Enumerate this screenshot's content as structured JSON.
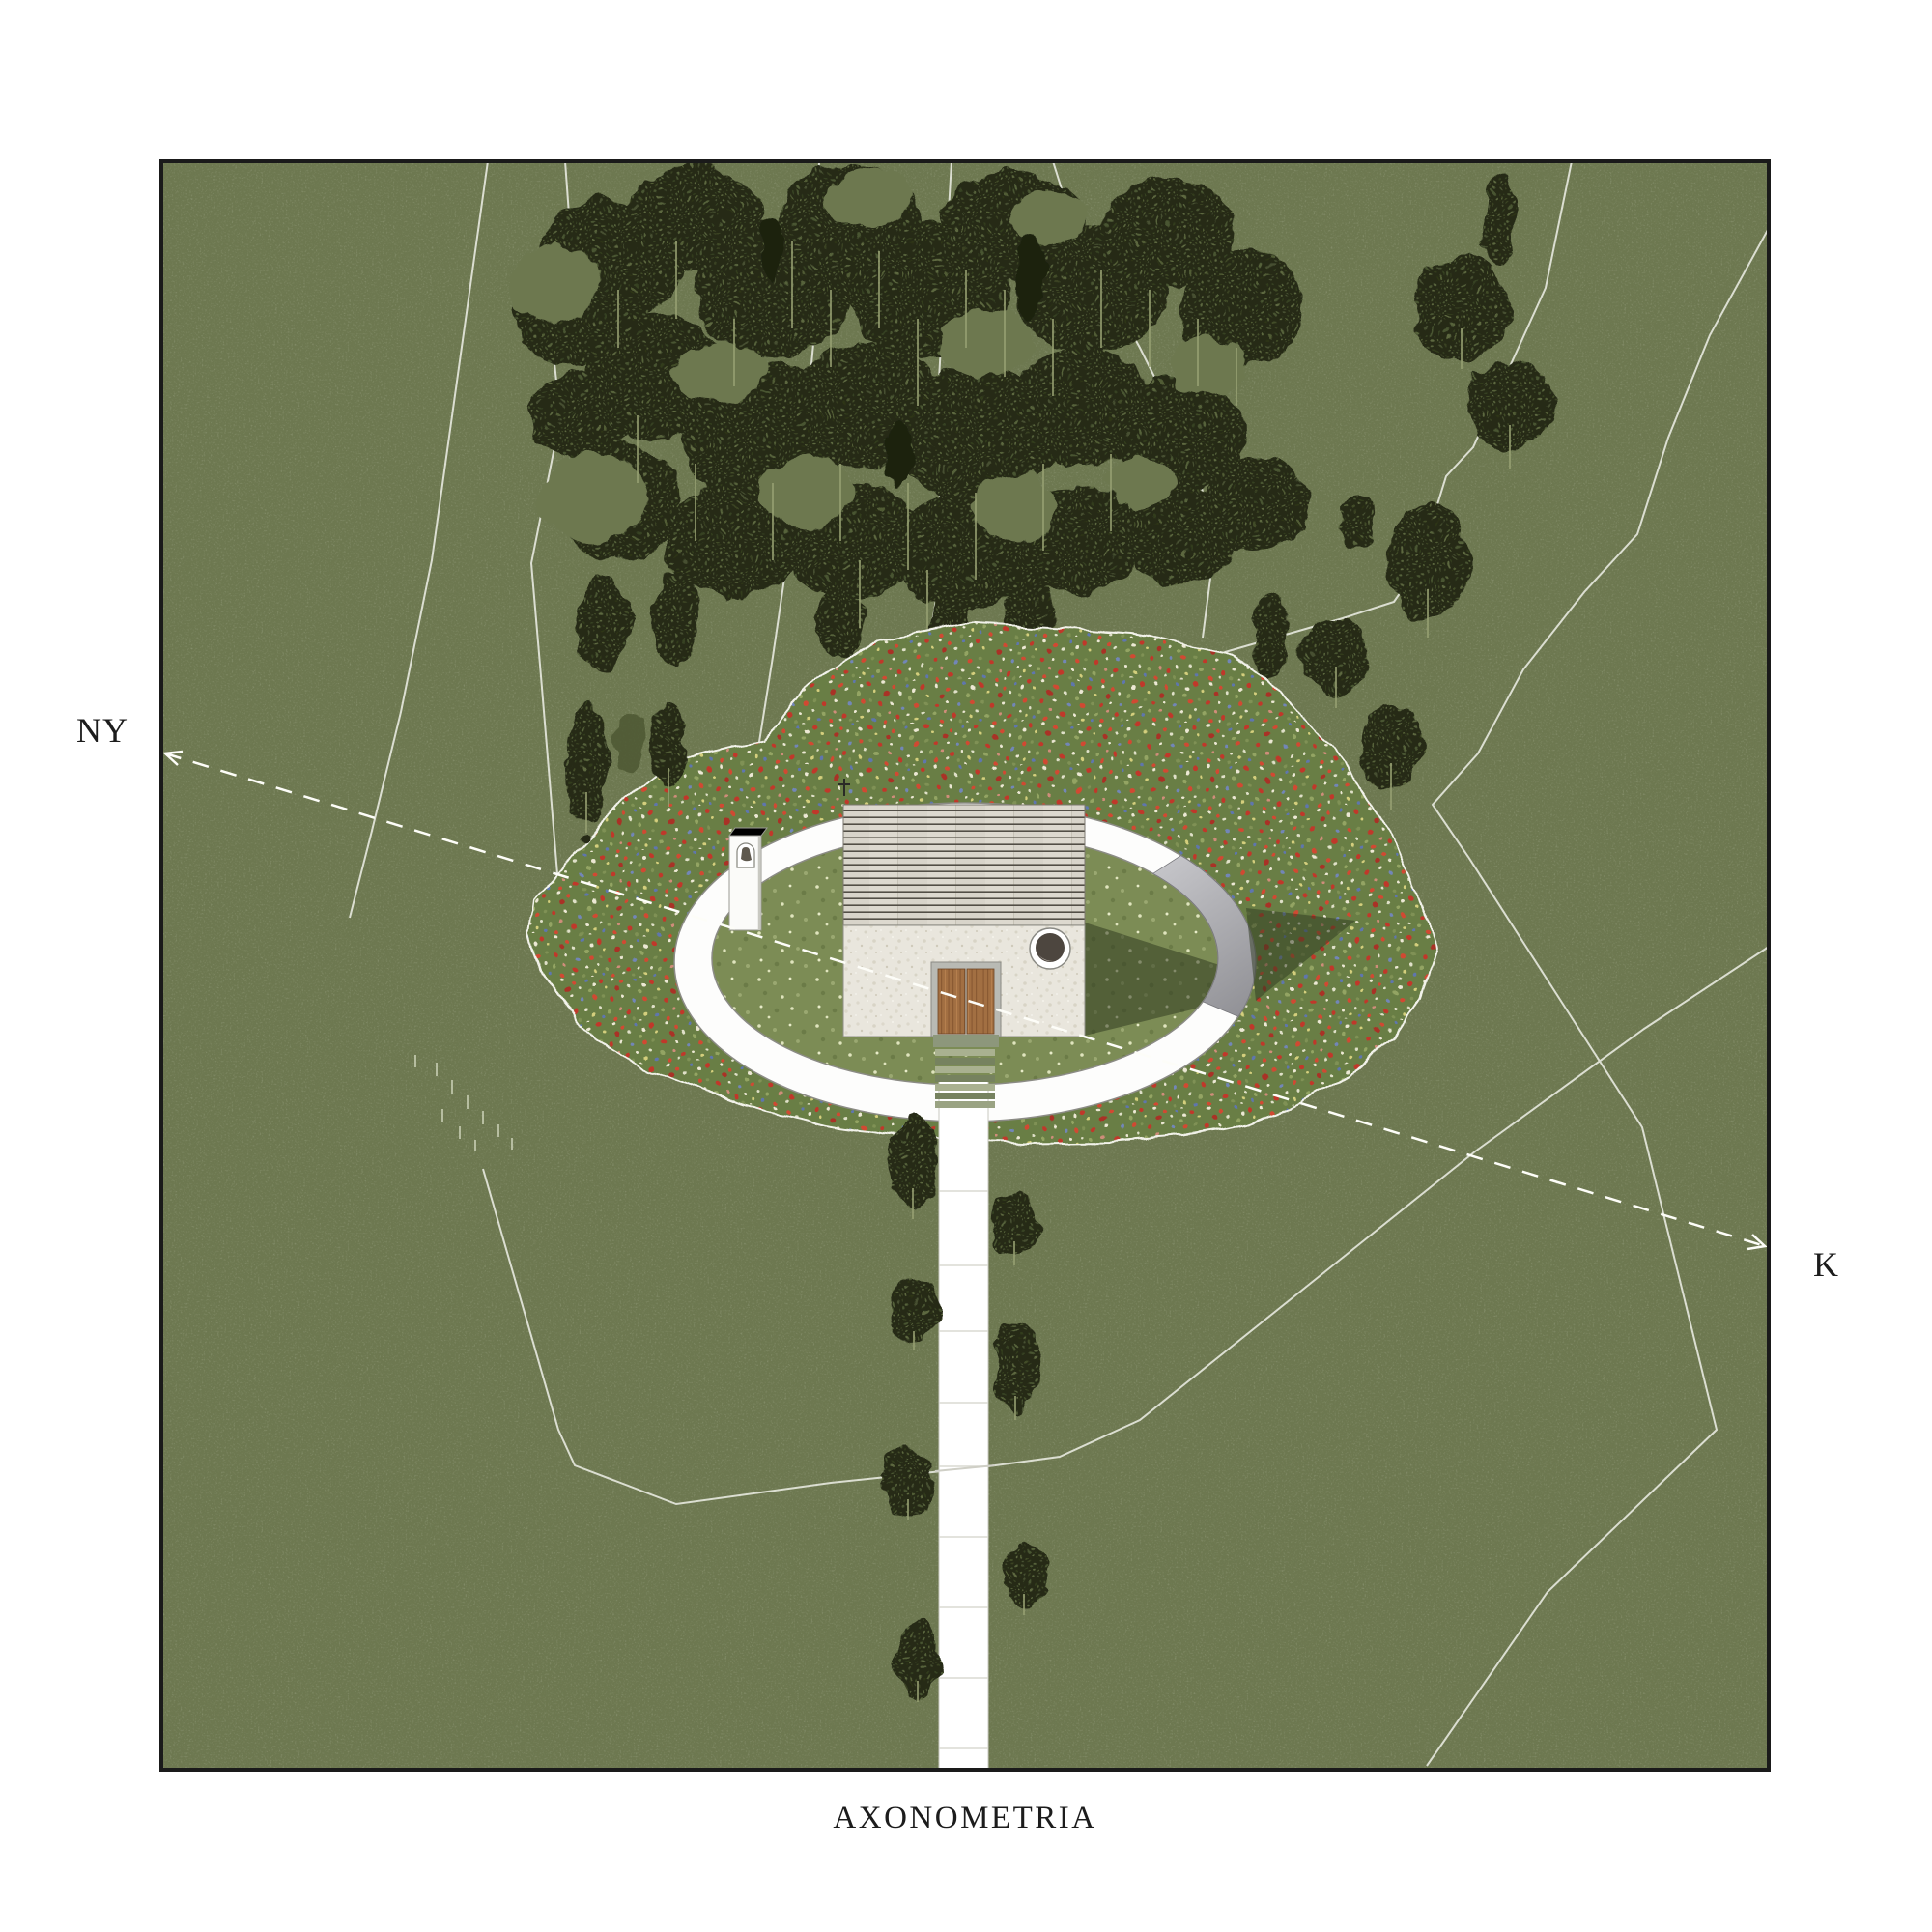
{
  "drawing": {
    "caption": "AXONOMETRIA",
    "compass": {
      "west_label": "NY",
      "east_label": "K"
    },
    "colors": {
      "paper_white": "#ffffff",
      "frame_black": "#1a1a1a",
      "field_olive": "#6d7850",
      "forest_dark": "#252a17",
      "meadow_green": "#697e44",
      "poppy_red": "#c0392b",
      "cornflower_blue": "#5f76ae",
      "lawn_green": "#7c8c55",
      "wall_white": "#fdfdfc",
      "wall_face_gray": "#a2a2a6",
      "roof_plank": "#d8d4ca",
      "stucco": "#e9e6dd",
      "door_wood": "#a26f42",
      "shadow_dark": "#2e381f",
      "path_white": "#ffffff",
      "dashed_axis_white": "#fdfdf8"
    },
    "site_features": [
      "forest",
      "wildflower-meadow",
      "elliptical-enclosure-wall",
      "bell-pillar",
      "chapel",
      "entry-steps",
      "access-path",
      "boundary-lines",
      "axis-ny-k"
    ]
  }
}
